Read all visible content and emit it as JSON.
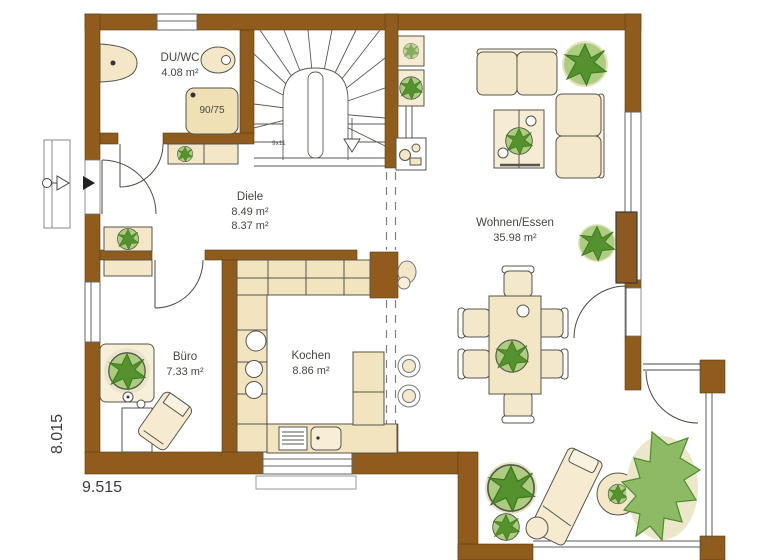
{
  "rooms": {
    "duwc": {
      "name": "DU/WC",
      "area": "4.08 m²"
    },
    "diele": {
      "name": "Diele",
      "area_1": "8.49 m²",
      "area_2": "8.37 m²"
    },
    "buero": {
      "name": "Büro",
      "area": "7.33 m²"
    },
    "kochen": {
      "name": "Kochen",
      "area": "8.86 m²"
    },
    "wohnen": {
      "name": "Wohnen/Essen",
      "area": "35.98 m²"
    }
  },
  "annotations": {
    "shower_size": "90/75",
    "stair_note": "9x11",
    "dimension_bottom": "9.515",
    "dimension_left": "8.015"
  },
  "colors": {
    "wall_brown": "#8f5c1e",
    "furniture_cream": "#f4e7c7",
    "furniture_shade": "#ecd9a8",
    "plant_green": "#7fb254",
    "plant_dark": "#55912e",
    "line": "#4a4a42"
  }
}
